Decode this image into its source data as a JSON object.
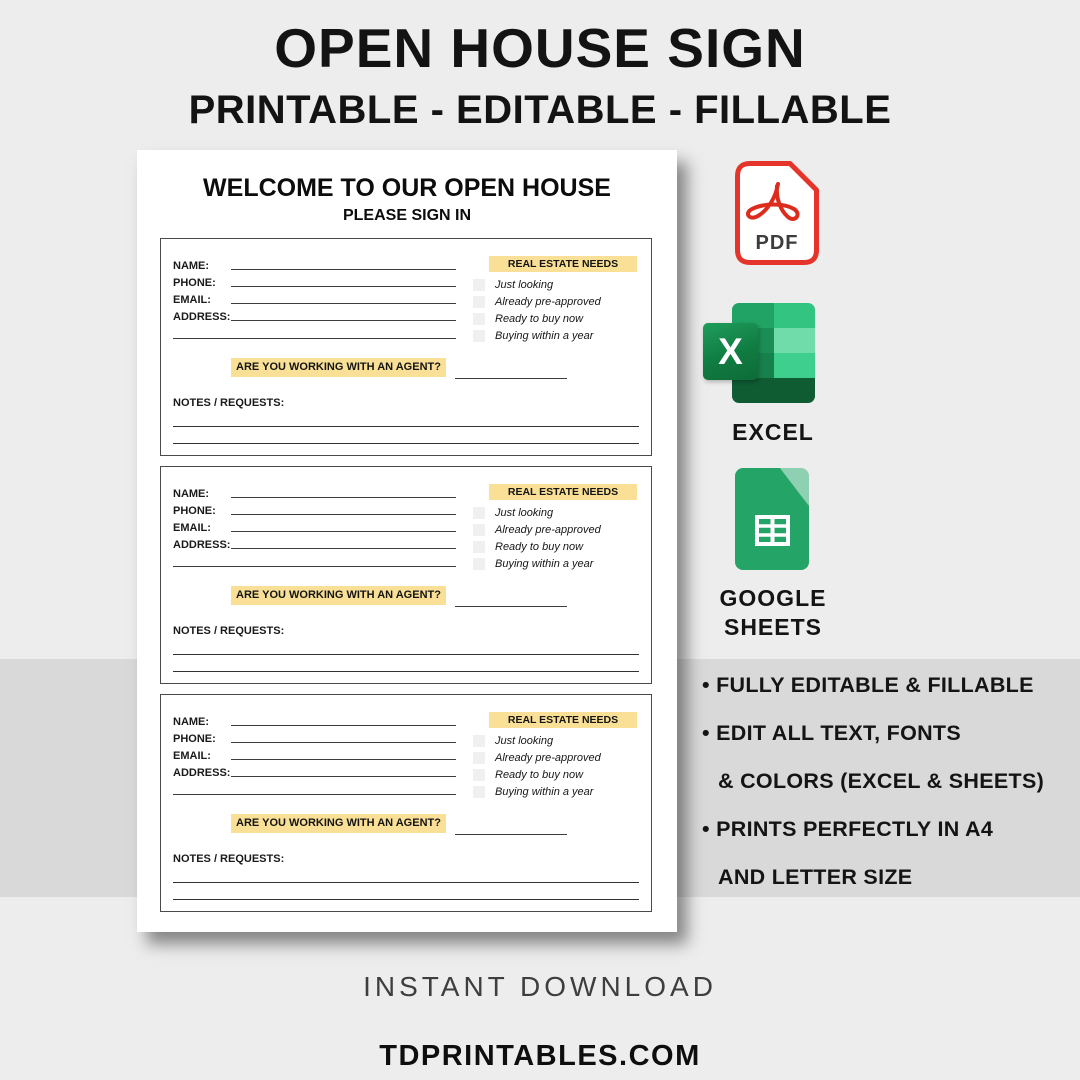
{
  "header": {
    "title": "OPEN HOUSE SIGN",
    "subtitle": "PRINTABLE - EDITABLE - FILLABLE"
  },
  "paper": {
    "heading": "WELCOME TO OUR OPEN HOUSE",
    "subheading": "PLEASE SIGN IN",
    "section_count": 3,
    "section": {
      "fields": [
        "NAME:",
        "PHONE:",
        "EMAIL:",
        "ADDRESS:"
      ],
      "needs_header": "REAL ESTATE NEEDS",
      "needs_options": [
        "Just looking",
        "Already pre-approved",
        "Ready to buy now",
        "Buying within a year"
      ],
      "agent_question": "ARE YOU WORKING WITH AN AGENT?",
      "notes_label": "NOTES / REQUESTS:"
    }
  },
  "formats": {
    "pdf": {
      "label": "PDF"
    },
    "excel": {
      "label": "EXCEL",
      "logo_letter": "X"
    },
    "sheets": {
      "label": "GOOGLE SHEETS"
    }
  },
  "features": [
    "• FULLY EDITABLE & FILLABLE",
    "• EDIT ALL TEXT, FONTS",
    "& COLORS (EXCEL & SHEETS)",
    "• PRINTS PERFECTLY IN A4",
    "AND LETTER SIZE"
  ],
  "footer": {
    "download_text": "INSTANT DOWNLOAD",
    "website": "TDPRINTABLES.COM"
  },
  "colors": {
    "background": "#EDEDED",
    "band_gray": "#D9D9D9",
    "highlight_yellow": "#F9E096",
    "pdf_red": "#E5352B",
    "excel_dark_green": "#0F5C33",
    "excel_green": "#107C41",
    "excel_mid_green": "#21A366",
    "excel_light_green": "#33C481",
    "sheets_green": "#24A466",
    "sheets_fold_green": "#8ED1B2"
  }
}
